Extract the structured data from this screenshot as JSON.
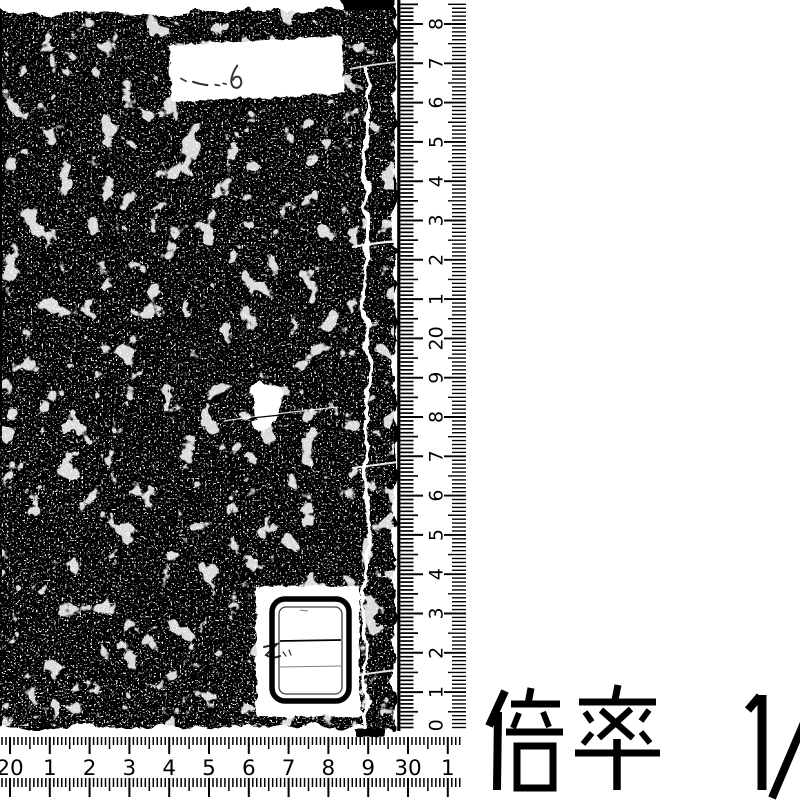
{
  "scan": {
    "description": "black-and-white archival scan of a stab-bound book cover with measurement rulers",
    "colors": {
      "ink": "#000000",
      "paper": "#ffffff"
    }
  },
  "magnification": {
    "label": "倍率",
    "value": "1/",
    "full_text": "倍率 1/"
  },
  "book": {
    "top_label": {
      "handwriting": "〜 6"
    },
    "bottom_label": {
      "handwriting": "乙"
    }
  },
  "vertical_ruler": {
    "labels_top_to_bottom": [
      "8",
      "7",
      "6",
      "5",
      "4",
      "3",
      "2",
      "1",
      "20",
      "9",
      "8",
      "7",
      "6",
      "5",
      "4",
      "3",
      "2",
      "1",
      "10"
    ]
  },
  "horizontal_ruler": {
    "labels_left_to_right": [
      "20",
      "1",
      "2",
      "3",
      "4",
      "5",
      "6",
      "7",
      "8",
      "9",
      "30",
      "1"
    ]
  }
}
